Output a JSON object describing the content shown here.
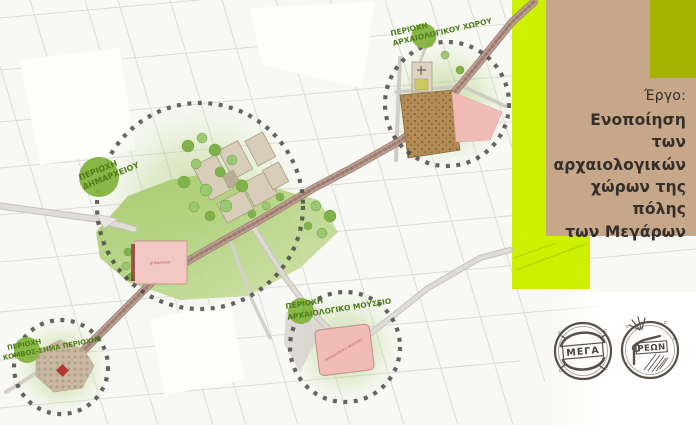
{
  "project_panel": {
    "label": "Έργο:",
    "title_lines": [
      "Ενοποίηση των",
      "αρχαιολογικών",
      "χώρων της πόλης",
      "των Μεγάρων"
    ],
    "panel_color": "#c7a78a",
    "accent_block_color": "#a4b400",
    "highlight_bar_color": "#cdf000"
  },
  "map": {
    "area_labels": [
      {
        "id": "city-hall-area",
        "line1": "ΠΕΡΙΟΧΗ",
        "line2": "ΔΗΜΑΡΧΕΙΟΥ"
      },
      {
        "id": "archaeological-site-area",
        "line1": "ΠΕΡΙΟΧΗ",
        "line2": "ΑΡΧΑΙΟΛΟΓΙΚΟΥ ΧΩΡΟΥ"
      },
      {
        "id": "archaeological-museum-area",
        "line1": "ΠΕΡΙΟΧΗ",
        "line2": "ΑΡΧΑΙΟΛΟΓΙΚΟ ΜΟΥΣΕΙΟ"
      },
      {
        "id": "node-landmark-area",
        "line1": "ΠΕΡΙΟΧΗ",
        "line2": "ΚΟΜΒΟΣ-ΣΗΜΑ ΠΕΡΙΟΧΗΣ"
      }
    ],
    "building_labels": {
      "city_hall": "ΔΗΜΑΡΧΕΙΟ",
      "museum": "ΑΡΧΑΙΟΛΟΓΙΚΟ ΜΟΥΣΕΙΟ"
    },
    "label_color": "#4e7d1a",
    "label_circle_color": "#84b43e"
  },
  "coins": {
    "left_text": "ΜΕΓΑ",
    "right_text": "ΡΕΩΝ"
  }
}
